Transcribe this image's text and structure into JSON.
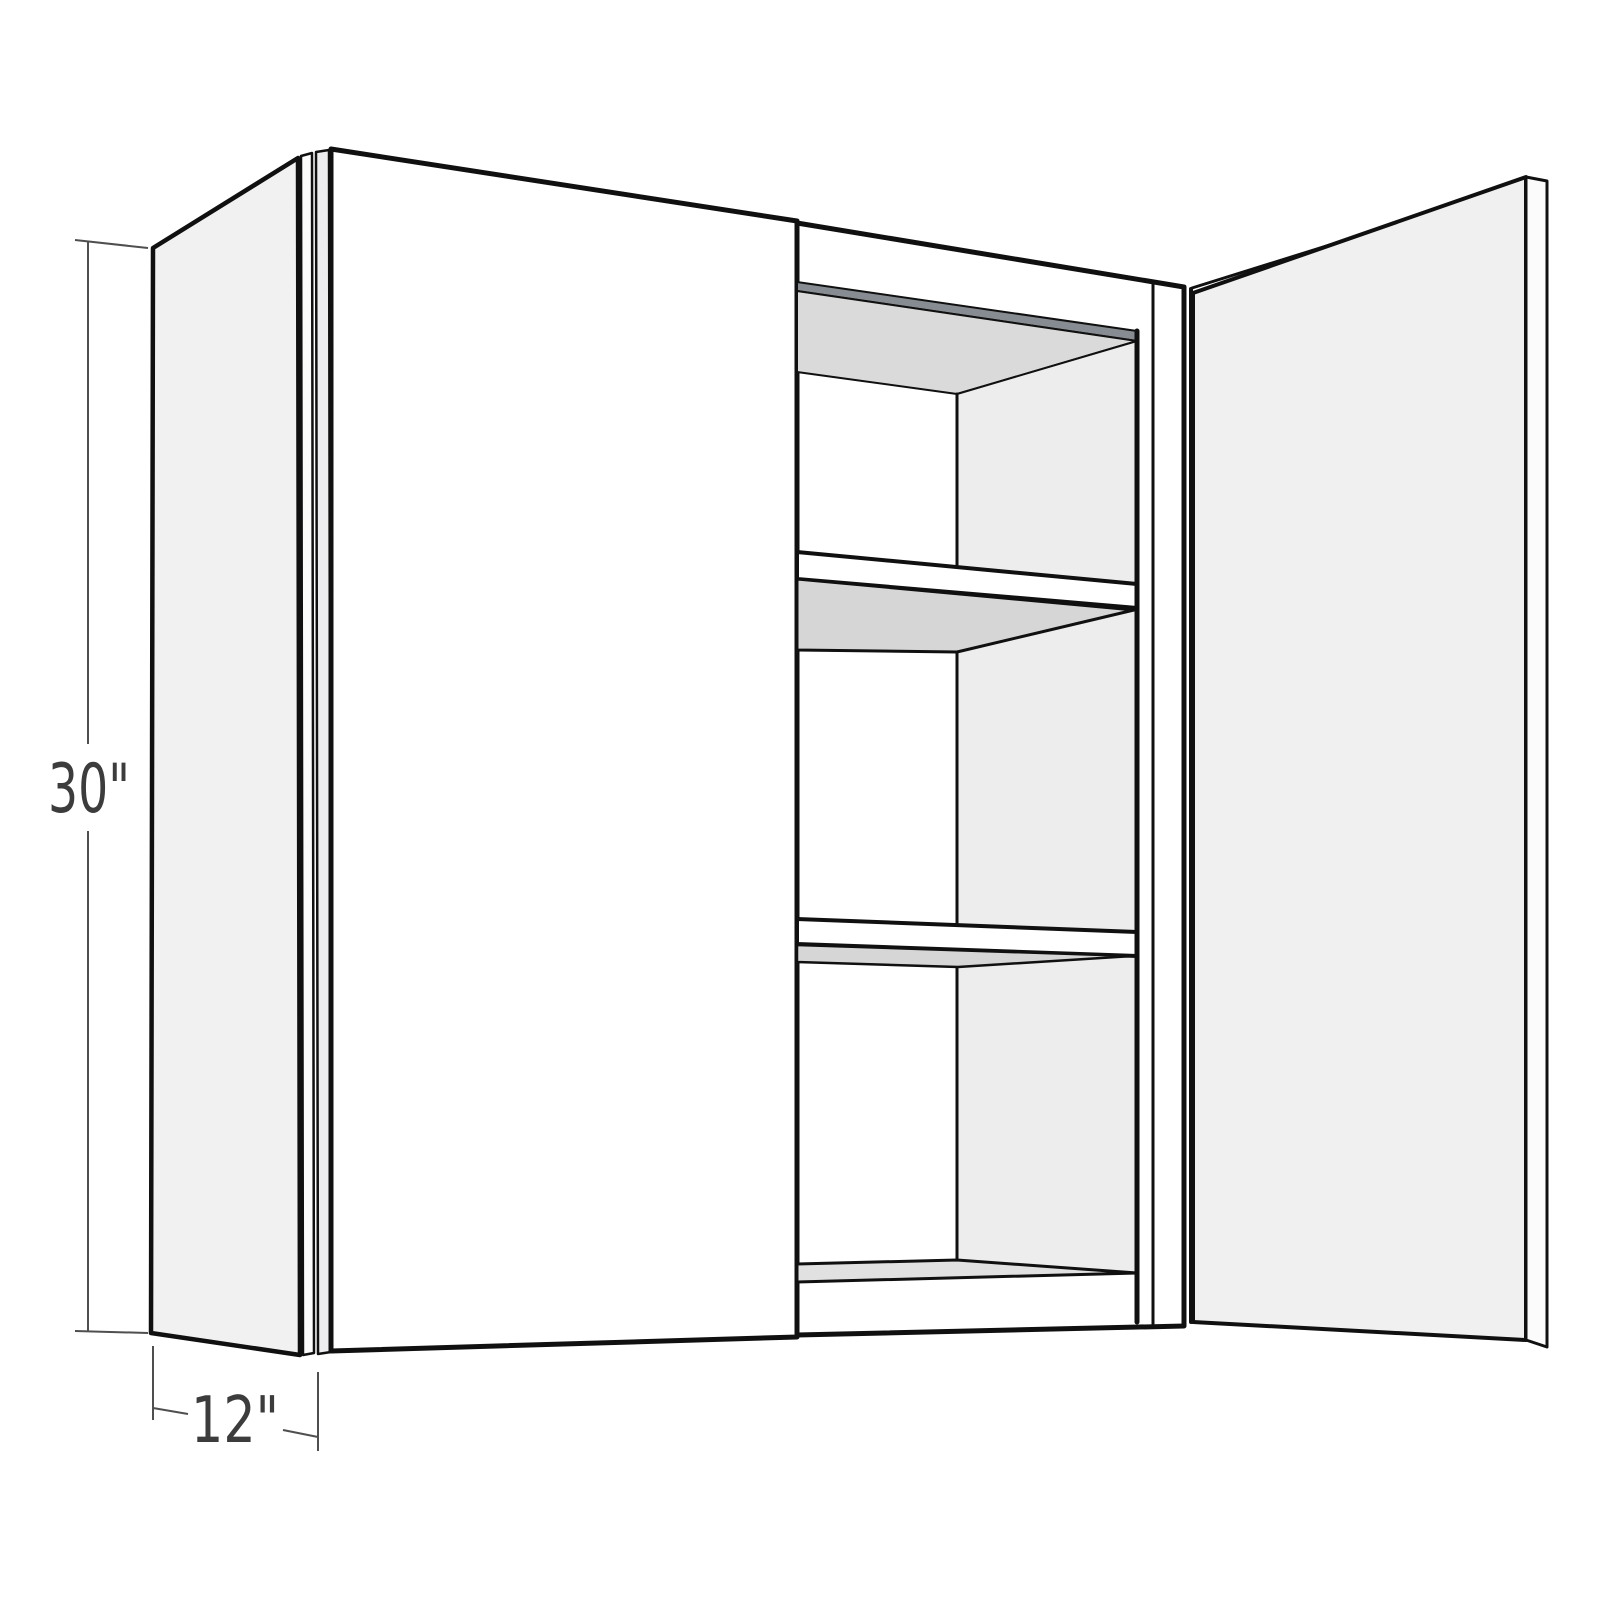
{
  "diagram": {
    "dimensions": {
      "height_label": "30\"",
      "depth_label": "12\""
    },
    "colors": {
      "background": "#ffffff",
      "outline": "#101010",
      "dimension_line": "#4f4f4f",
      "label_text": "#3c3c3c",
      "side_panel": "#f1f1f2",
      "door_front": "#ffffff",
      "open_door_face": "#f0f0f1",
      "edge_band_light": "#fbfbfc",
      "edge_band_shaded": "#ededef",
      "box_front": "#ffffff",
      "interior_side_wall": "#ededee",
      "interior_back_wall": "#ffffff",
      "interior_ceiling": "#dadadb",
      "top_rail_shadow": "#868c91",
      "shelf_front": "#ffffff",
      "shelf_underside": "#d6d6d7",
      "cabinet_floor": "#e1e1e2"
    }
  }
}
